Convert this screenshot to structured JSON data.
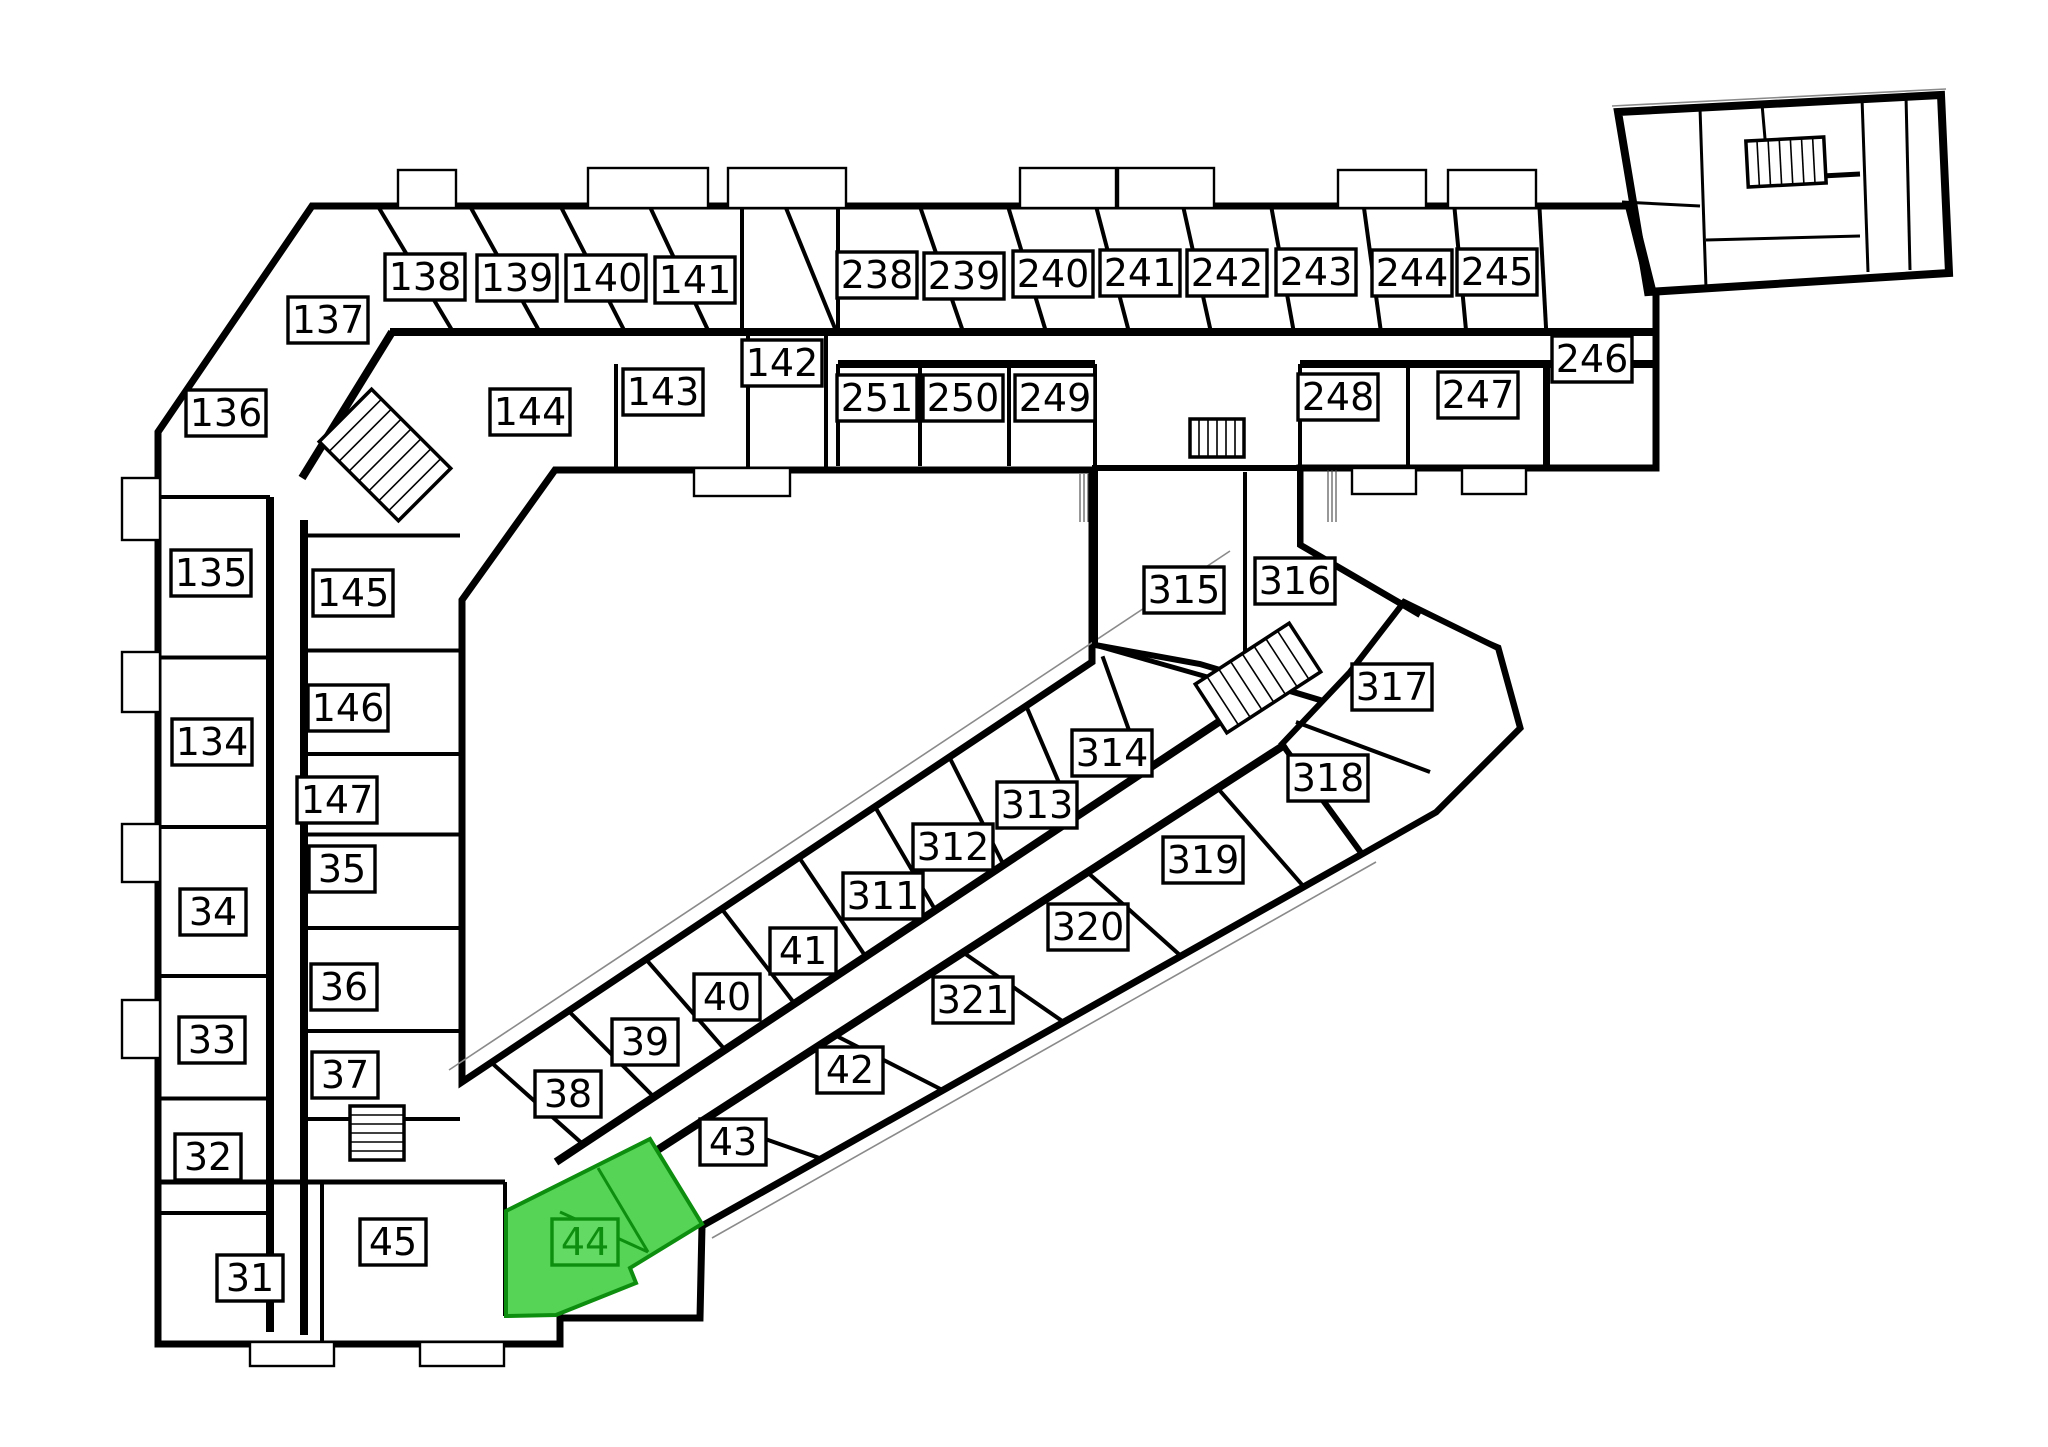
{
  "page": {
    "kind": "architectural-floor-plan",
    "background": "#ffffff"
  },
  "highlight": {
    "unit": "44",
    "fill": "#55d455",
    "label_fill": "#63da63",
    "stroke": "#0e8e0e"
  },
  "units": [
    {
      "id": "138",
      "x": 425,
      "y": 277
    },
    {
      "id": "139",
      "x": 517,
      "y": 278
    },
    {
      "id": "140",
      "x": 606,
      "y": 278
    },
    {
      "id": "141",
      "x": 695,
      "y": 280
    },
    {
      "id": "137",
      "x": 328,
      "y": 320
    },
    {
      "id": "136",
      "x": 226,
      "y": 413
    },
    {
      "id": "142",
      "x": 782,
      "y": 363
    },
    {
      "id": "143",
      "x": 663,
      "y": 392
    },
    {
      "id": "144",
      "x": 530,
      "y": 412
    },
    {
      "id": "145",
      "x": 353,
      "y": 593
    },
    {
      "id": "135",
      "x": 211,
      "y": 573
    },
    {
      "id": "146",
      "x": 348,
      "y": 708
    },
    {
      "id": "134",
      "x": 212,
      "y": 742
    },
    {
      "id": "147",
      "x": 337,
      "y": 800
    },
    {
      "id": "35",
      "x": 342,
      "y": 869
    },
    {
      "id": "34",
      "x": 213,
      "y": 912
    },
    {
      "id": "36",
      "x": 344,
      "y": 987
    },
    {
      "id": "33",
      "x": 212,
      "y": 1040
    },
    {
      "id": "37",
      "x": 345,
      "y": 1075
    },
    {
      "id": "32",
      "x": 208,
      "y": 1157
    },
    {
      "id": "31",
      "x": 250,
      "y": 1278
    },
    {
      "id": "45",
      "x": 393,
      "y": 1242
    },
    {
      "id": "44",
      "x": 585,
      "y": 1242,
      "highlighted": true
    },
    {
      "id": "38",
      "x": 568,
      "y": 1094
    },
    {
      "id": "39",
      "x": 645,
      "y": 1042
    },
    {
      "id": "40",
      "x": 727,
      "y": 997
    },
    {
      "id": "41",
      "x": 803,
      "y": 951
    },
    {
      "id": "43",
      "x": 733,
      "y": 1142
    },
    {
      "id": "42",
      "x": 850,
      "y": 1070
    },
    {
      "id": "238",
      "x": 877,
      "y": 275
    },
    {
      "id": "239",
      "x": 964,
      "y": 276
    },
    {
      "id": "240",
      "x": 1053,
      "y": 274
    },
    {
      "id": "241",
      "x": 1140,
      "y": 273
    },
    {
      "id": "242",
      "x": 1227,
      "y": 273
    },
    {
      "id": "243",
      "x": 1316,
      "y": 272
    },
    {
      "id": "244",
      "x": 1412,
      "y": 273
    },
    {
      "id": "245",
      "x": 1497,
      "y": 272
    },
    {
      "id": "246",
      "x": 1592,
      "y": 359
    },
    {
      "id": "247",
      "x": 1478,
      "y": 395
    },
    {
      "id": "248",
      "x": 1338,
      "y": 397
    },
    {
      "id": "249",
      "x": 1055,
      "y": 398
    },
    {
      "id": "250",
      "x": 963,
      "y": 398
    },
    {
      "id": "251",
      "x": 877,
      "y": 398
    },
    {
      "id": "311",
      "x": 883,
      "y": 896
    },
    {
      "id": "312",
      "x": 953,
      "y": 847
    },
    {
      "id": "313",
      "x": 1037,
      "y": 805
    },
    {
      "id": "314",
      "x": 1112,
      "y": 753
    },
    {
      "id": "315",
      "x": 1184,
      "y": 590
    },
    {
      "id": "316",
      "x": 1295,
      "y": 581
    },
    {
      "id": "317",
      "x": 1392,
      "y": 687
    },
    {
      "id": "318",
      "x": 1328,
      "y": 778
    },
    {
      "id": "319",
      "x": 1203,
      "y": 860
    },
    {
      "id": "320",
      "x": 1088,
      "y": 927
    },
    {
      "id": "321",
      "x": 973,
      "y": 1000
    }
  ],
  "floorplan": {
    "canvas": {
      "w": 2048,
      "h": 1447
    },
    "outline": [
      [
        158,
        432
      ],
      [
        312,
        206
      ],
      [
        1656,
        206
      ],
      [
        1656,
        468
      ],
      [
        1300,
        468
      ],
      [
        1300,
        545
      ],
      [
        1420,
        615
      ],
      [
        1498,
        648
      ],
      [
        1520,
        728
      ],
      [
        1436,
        812
      ],
      [
        1362,
        854
      ],
      [
        702,
        1226
      ],
      [
        700,
        1318
      ],
      [
        560,
        1318
      ],
      [
        560,
        1344
      ],
      [
        158,
        1344
      ]
    ],
    "courtyard": [
      [
        555,
        470
      ],
      [
        1092,
        470
      ],
      [
        1092,
        662
      ],
      [
        462,
        1082
      ],
      [
        462,
        600
      ]
    ],
    "connector_block": [
      [
        1095,
        468
      ],
      [
        1300,
        468
      ],
      [
        1300,
        545
      ],
      [
        1418,
        614
      ],
      [
        1340,
        706
      ],
      [
        1200,
        664
      ],
      [
        1095,
        645
      ]
    ],
    "tip_block": [
      [
        1404,
        602
      ],
      [
        1498,
        648
      ],
      [
        1520,
        728
      ],
      [
        1436,
        812
      ],
      [
        1362,
        854
      ],
      [
        1282,
        744
      ],
      [
        1350,
        672
      ]
    ],
    "detached_block": [
      [
        1618,
        112
      ],
      [
        1941,
        95
      ],
      [
        1949,
        273
      ],
      [
        1648,
        292
      ]
    ],
    "detached_inner_walls": [
      [
        1700,
        108,
        1706,
        288,
        3
      ],
      [
        1762,
        104,
        1766,
        150,
        3
      ],
      [
        1622,
        202,
        1700,
        206,
        3
      ],
      [
        1822,
        176,
        1860,
        174,
        5
      ],
      [
        1862,
        98,
        1868,
        272,
        3
      ],
      [
        1706,
        240,
        1860,
        236,
        3
      ],
      [
        1906,
        96,
        1910,
        270,
        3
      ]
    ],
    "detached_stair_box": {
      "x": 1764,
      "y": 146,
      "w": 42,
      "h": 38,
      "sw": 3
    },
    "green_unit": [
      [
        506,
        1211
      ],
      [
        596,
        1166
      ],
      [
        650,
        1139
      ],
      [
        702,
        1224
      ],
      [
        630,
        1268
      ],
      [
        636,
        1283
      ],
      [
        556,
        1315
      ],
      [
        506,
        1316
      ]
    ],
    "green_inner_walls": [
      [
        598,
        1168,
        648,
        1252
      ],
      [
        560,
        1212,
        648,
        1252
      ]
    ],
    "wings": [
      {
        "rooms": [
          "138",
          "139",
          "140",
          "141",
          "238",
          "239",
          "240",
          "241",
          "242",
          "243",
          "244",
          "245"
        ],
        "outer": [
          [
            312,
            208
          ],
          [
            1656,
            208
          ]
        ],
        "inner": [
          [
            390,
            332
          ],
          [
            1656,
            332
          ]
        ],
        "caps": [
          true,
          true
        ],
        "innerW": 8
      },
      {
        "rooms": [
          "251",
          "250",
          "249"
        ],
        "outer": [
          [
            838,
            466
          ],
          [
            1095,
            466
          ]
        ],
        "inner": [
          [
            838,
            364
          ],
          [
            1095,
            364
          ]
        ],
        "caps": [
          true,
          true
        ],
        "innerW": 8
      },
      {
        "rooms": [
          "248",
          "247"
        ],
        "outer": [
          [
            1300,
            466
          ],
          [
            1656,
            466
          ]
        ],
        "inner": [
          [
            1300,
            364
          ],
          [
            1656,
            364
          ]
        ],
        "caps": [
          true,
          true
        ],
        "innerW": 8
      },
      {
        "rooms": [
          "135",
          "134",
          "34",
          "33",
          "32"
        ],
        "outer": [
          [
            160,
            497
          ],
          [
            160,
            1213
          ]
        ],
        "inner": [
          [
            270,
            497
          ],
          [
            270,
            1213
          ]
        ],
        "caps": [
          true,
          true
        ],
        "innerW": 8
      },
      {
        "rooms": [
          "145",
          "146",
          "147",
          "35",
          "36",
          "37"
        ],
        "outer": [
          [
            460,
            520
          ],
          [
            460,
            1160
          ]
        ],
        "inner": [
          [
            304,
            520
          ],
          [
            304,
            1160
          ]
        ],
        "caps": [
          true,
          true
        ],
        "innerW": 8
      },
      {
        "rooms": [
          "38",
          "39",
          "40",
          "41",
          "311",
          "312",
          "313",
          "314"
        ],
        "outer": [
          [
            462,
            1082
          ],
          [
            1240,
            565
          ]
        ],
        "inner": [
          [
            556,
            1162
          ],
          [
            1270,
            688
          ]
        ],
        "caps": [
          true,
          true
        ],
        "innerW": 8
      },
      {
        "rooms": [
          "43",
          "42",
          "321",
          "320",
          "319",
          "318"
        ],
        "outer": [
          [
            702,
            1226
          ],
          [
            1368,
            850
          ]
        ],
        "inner": [
          [
            580,
            1200
          ],
          [
            1286,
            744
          ]
        ],
        "caps": [
          false,
          false
        ],
        "innerW": 8
      }
    ],
    "walls": [
      [
        748,
        334,
        748,
        468,
        4
      ],
      [
        826,
        334,
        826,
        468,
        4
      ],
      [
        616,
        364,
        616,
        468,
        4
      ],
      [
        1095,
        468,
        1095,
        645,
        6
      ],
      [
        1300,
        468,
        1300,
        545,
        6
      ],
      [
        1300,
        545,
        1420,
        615,
        6
      ],
      [
        1095,
        645,
        1260,
        692,
        5
      ],
      [
        1245,
        472,
        1245,
        658,
        4
      ],
      [
        1296,
        722,
        1430,
        772,
        4
      ],
      [
        160,
        1182,
        505,
        1182,
        5
      ],
      [
        322,
        1182,
        322,
        1344,
        4
      ],
      [
        505,
        1182,
        505,
        1316,
        4
      ],
      [
        742,
        208,
        742,
        330,
        4
      ],
      [
        838,
        208,
        838,
        330,
        4
      ],
      [
        1545,
        364,
        1545,
        466,
        4
      ],
      [
        392,
        332,
        302,
        478,
        8
      ],
      [
        1630,
        206,
        1652,
        294,
        10
      ],
      [
        270,
        1213,
        270,
        1332,
        8
      ],
      [
        304,
        1119,
        304,
        1335,
        8
      ]
    ],
    "facade_lines": [
      [
        449,
        1070,
        1230,
        551
      ],
      [
        712,
        1238,
        1376,
        862
      ],
      [
        1612,
        106,
        1946,
        89
      ]
    ],
    "stairs": [
      {
        "cx": 385,
        "cy": 455,
        "w": 112,
        "h": 74,
        "rot": 45,
        "n": 7
      },
      {
        "cx": 1217,
        "cy": 438,
        "w": 54,
        "h": 38,
        "rot": 0,
        "n": 5
      },
      {
        "cx": 1258,
        "cy": 678,
        "w": 112,
        "h": 58,
        "rot": -33,
        "n": 7
      },
      {
        "cx": 377,
        "cy": 1133,
        "w": 54,
        "h": 54,
        "rot": 90,
        "n": 5
      },
      {
        "cx": 1786,
        "cy": 162,
        "w": 78,
        "h": 46,
        "rot": -3,
        "n": 6
      }
    ],
    "bumps": [
      [
        398,
        170,
        58,
        38
      ],
      [
        588,
        168,
        120,
        40
      ],
      [
        728,
        168,
        118,
        40
      ],
      [
        1020,
        168,
        96,
        40
      ],
      [
        1118,
        168,
        96,
        40
      ],
      [
        1338,
        170,
        88,
        38
      ],
      [
        1448,
        170,
        88,
        38
      ],
      [
        694,
        468,
        96,
        28
      ],
      [
        1352,
        468,
        64,
        26
      ],
      [
        1462,
        468,
        64,
        26
      ],
      [
        122,
        478,
        38,
        62
      ],
      [
        122,
        652,
        38,
        60
      ],
      [
        122,
        824,
        38,
        58
      ],
      [
        122,
        1000,
        38,
        58
      ],
      [
        250,
        1342,
        84,
        24
      ],
      [
        420,
        1342,
        84,
        24
      ]
    ],
    "micro_annotations": [
      {
        "x": 1080,
        "y": 474,
        "len": 48
      },
      {
        "x": 1328,
        "y": 470,
        "len": 52
      }
    ]
  }
}
